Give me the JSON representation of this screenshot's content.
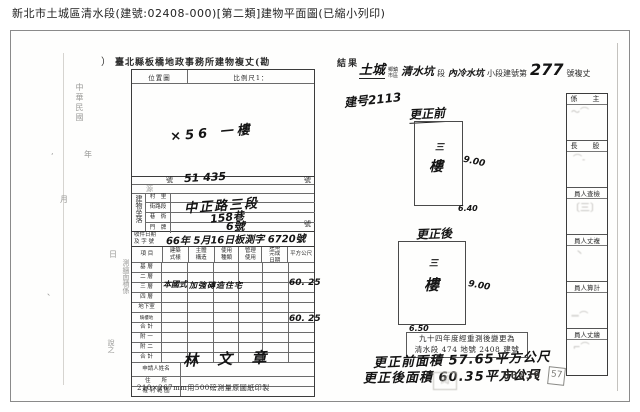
{
  "page": {
    "title": "新北市土城區清水段(建號:02408-000)[第二類]建物平面圖(已縮小列印)"
  },
  "form": {
    "paren_mark": "）",
    "header": "臺北縣板橋地政事務所建物複丈(勘",
    "header_result": "結果",
    "map": {
      "label": "位置圖",
      "scale": "比例尺1：",
      "annotation": "×56 一樓"
    },
    "margin": {
      "era": "中華民國",
      "year": "年",
      "month": "月",
      "day": "日",
      "note": "測繪面積係",
      "note2": "說之"
    },
    "row_no": {
      "prefix": "號",
      "value": "51  435",
      "suffix": "號"
    },
    "row_src": {
      "label": "源"
    },
    "location": {
      "label": "建物坐落",
      "r1": "村　里",
      "r2": "街路段",
      "r3": "巷　衖",
      "r4": "門　牌",
      "hw1": "中正路三段",
      "hw2": "158巷",
      "hw3": "6號",
      "suffix": "號"
    },
    "receipt": {
      "label1": "收件日期",
      "label2": "及 字 號",
      "value": "66年 5月16日板測字 6720號"
    },
    "table": {
      "h": [
        "項 目",
        "建築式樣",
        "主體構造",
        "使用種類",
        "管理使用",
        "建築完成日期",
        "平方公尺"
      ],
      "rows": [
        "基 層",
        "二 層",
        "三 層",
        "四 層",
        "地下室",
        "騎樓地",
        "合 計",
        "附 一",
        "附 二",
        "合 計"
      ],
      "hw_style": "本國式",
      "hw_structure": "加強磚造住宅",
      "hw_area3": "60. 25",
      "hw_area_total": "60. 25"
    },
    "applicant": {
      "label": "申請人姓名",
      "value": "林 文 章"
    },
    "address_label": "住　　所",
    "rights_label": "權 利 範 圍",
    "footer": "210×267mm用500磅測量原圖紙印製"
  },
  "right": {
    "header": {
      "hw_town": "土城",
      "p_town1": "鄉鎮",
      "p_town2": "市區",
      "hw_sec": "清水坑",
      "p_sec": "段",
      "hw_sub": "內冷水坑",
      "p_sub": "小段建號第",
      "hw_no": "277",
      "p_tail": "號複丈"
    },
    "note": "建号2113",
    "before": {
      "label": "更正前",
      "f1": "三",
      "f2": "樓",
      "dim_r": "9.00",
      "dim_b": "6.40"
    },
    "after": {
      "label": "更正後",
      "f1": "三",
      "f2": "樓",
      "dim_r": "9.00",
      "dim_b": "6.50"
    },
    "box": {
      "line1": "九十四年度經重測後變更為",
      "line2": "清水段 474 地號 2408 建號"
    },
    "hw1": "更正前面積 57.65平方公尺",
    "hw2": "更正後面積 60.35平方公尺",
    "stamp_no": "00039",
    "stamp_small": "57",
    "stamps": [
      "係　主",
      "長　股",
      "員人查檢",
      "員人丈複",
      "員人算計",
      "員人丈繪"
    ]
  }
}
